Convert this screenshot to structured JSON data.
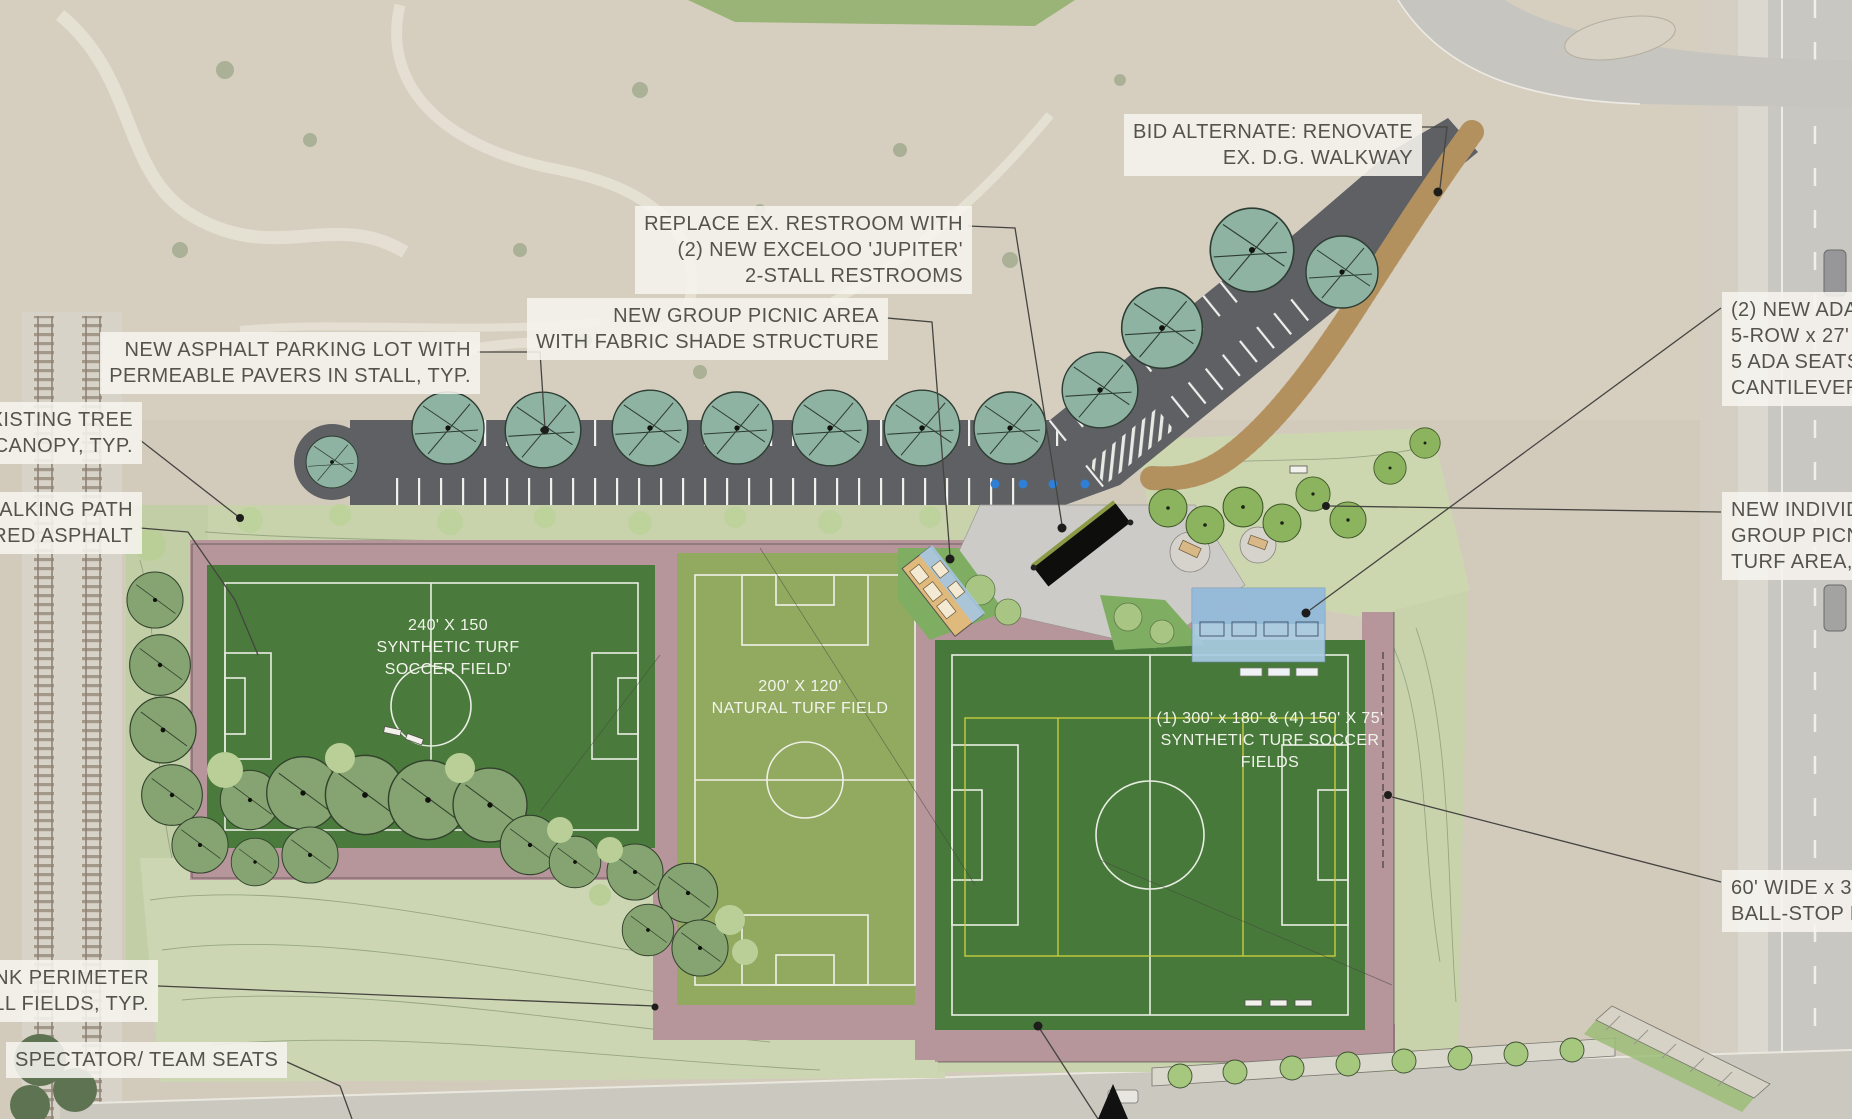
{
  "labels": {
    "bid_alternate": {
      "lines": [
        "BID ALTERNATE: RENOVATE",
        "EX. D.G. WALKWAY"
      ]
    },
    "restroom": {
      "lines": [
        "REPLACE EX. RESTROOM WITH",
        "(2) NEW EXCELOO 'JUPITER'",
        "2-STALL RESTROOMS"
      ]
    },
    "group_picnic": {
      "lines": [
        "NEW GROUP PICNIC AREA",
        "WITH FABRIC SHADE STRUCTURE"
      ]
    },
    "parking_lot": {
      "lines": [
        "NEW ASPHALT PARKING LOT WITH",
        "PERMEABLE PAVERS IN STALL, TYP."
      ]
    },
    "existing_tree": {
      "lines": [
        "EXISTING TREE",
        "CANOPY, TYP."
      ]
    },
    "walking_path": {
      "lines": [
        "WALKING PATH",
        "COLORED ASPHALT"
      ]
    },
    "ada_bleachers": {
      "lines": [
        "(2) NEW ADA",
        "5-ROW x 27'",
        "5 ADA SEATS",
        "CANTILEVER"
      ]
    },
    "individual_picnic": {
      "lines": [
        "NEW INDIVIDUAL",
        "GROUP PICNIC",
        "TURF AREA, TYP."
      ]
    },
    "ball_stop": {
      "lines": [
        "60' WIDE x 30'",
        "BALL-STOP NETTING"
      ]
    },
    "link_perimeter": {
      "lines": [
        "CHAIN LINK PERIMETER",
        "AT ALL FIELDS, TYP."
      ]
    },
    "spectator": {
      "lines": [
        "SPECTATOR/ TEAM SEATS"
      ]
    }
  },
  "fields": {
    "field1": {
      "lines": [
        "240' X 150",
        "SYNTHETIC TURF",
        "SOCCER FIELD'"
      ]
    },
    "field2": {
      "lines": [
        "200' X 120'",
        "NATURAL TURF FIELD"
      ]
    },
    "field3": {
      "lines": [
        "(1) 300' x 180' & (4) 150' X 75'",
        "SYNTHETIC TURF SOCCER",
        "FIELDS"
      ]
    }
  },
  "palette": {
    "desert": "#d2cbbc",
    "asphalt": "#5e6064",
    "synthetic_turf": "#4a7b3c",
    "natural_turf": "#92a960",
    "track_mauve": "#b6959b",
    "tree_teal": "#8fb3a2",
    "dg_walkway": "#bf9d6f",
    "plaza_gray": "#cccbc7",
    "road_gray": "#c9c7c1",
    "label_bg": "#f6f4ee",
    "label_text": "#54534d",
    "ada_blue": "#2f7fd6",
    "field_line_white": "#ffffff",
    "cross_field_yellow": "#cdd23e"
  }
}
